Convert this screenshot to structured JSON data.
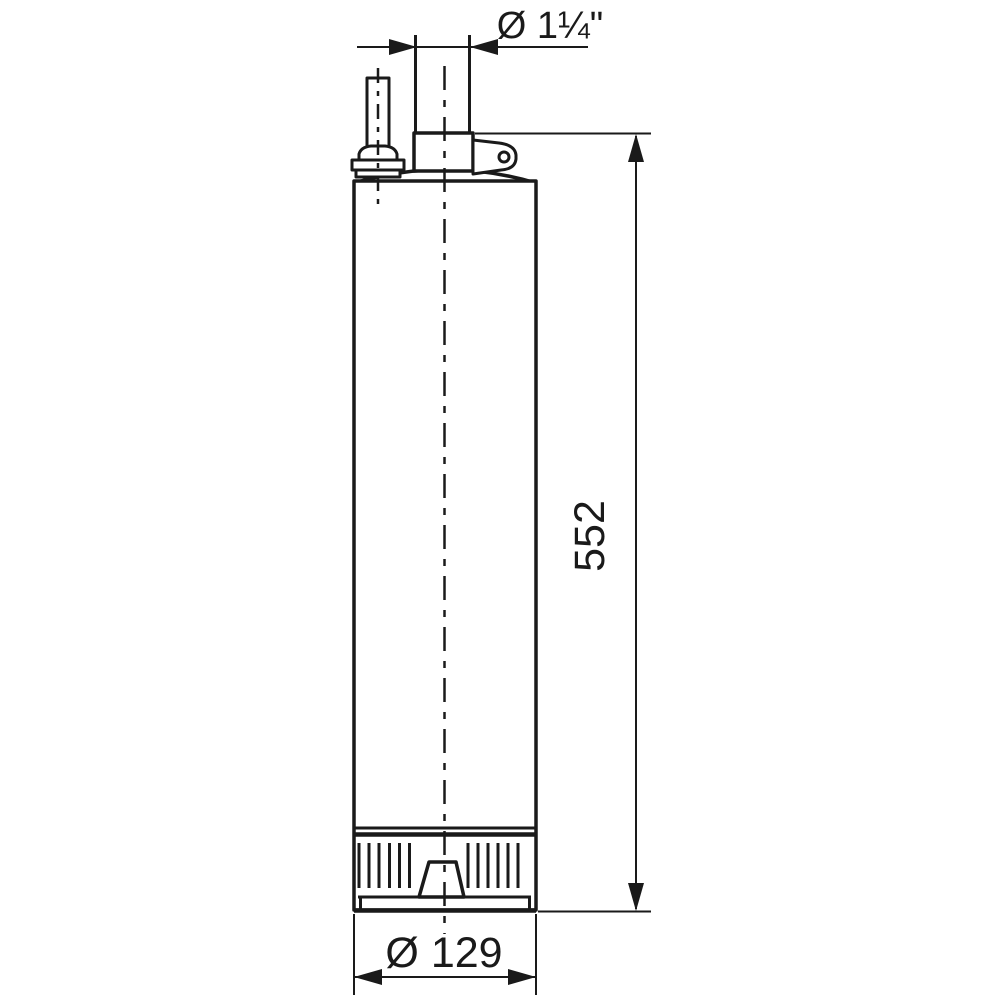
{
  "drawing": {
    "kind": "pump-dimension-drawing",
    "labels": {
      "top_diameter": "Ø 1¼\"",
      "height": "552",
      "bottom_diameter": "Ø 129"
    },
    "colors": {
      "line": "#1a1a1a",
      "background": "#ffffff"
    }
  }
}
